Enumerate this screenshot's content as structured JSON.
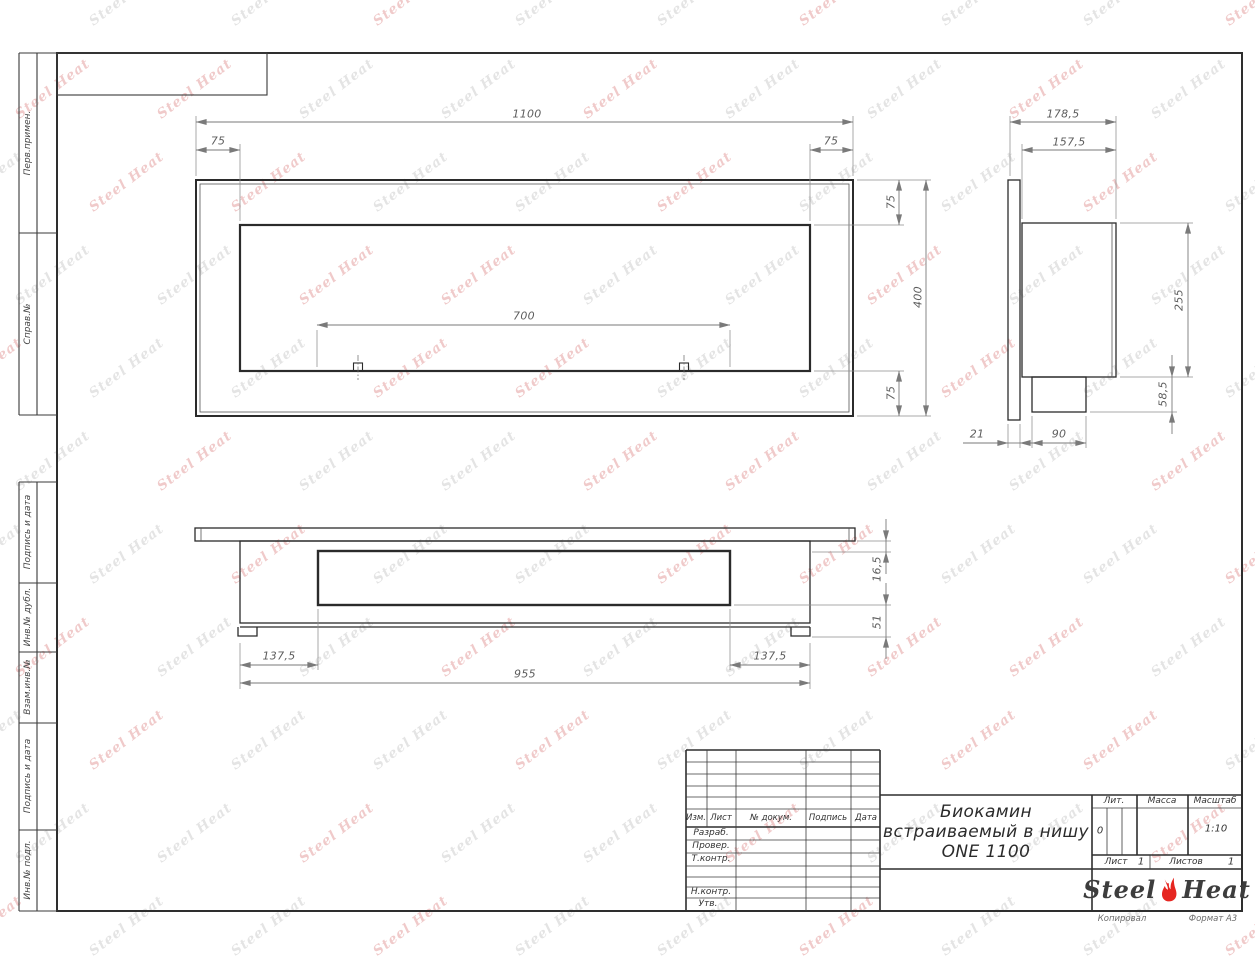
{
  "watermark": {
    "text": "Steel Heat"
  },
  "margin_labels": {
    "perv_primen": "Перв.примен.",
    "sprav_no": "Справ.№",
    "podpis_data_1": "Подпись и дата",
    "inv_dubl": "Инв.№ дубл.",
    "vzam_inv": "Взам.инв.№",
    "podpis_data_2": "Подпись и дата",
    "inv_podl": "Инв.№ подл."
  },
  "dims": {
    "front_width": "1100",
    "front_left_offset": "75",
    "front_right_offset": "75",
    "front_burner_length": "700",
    "front_top_offset": "75",
    "front_height": "400",
    "front_bottom_offset": "75",
    "side_depth_total": "178,5",
    "side_depth_body": "157,5",
    "side_body_height": "255",
    "side_box_height": "58,5",
    "side_flange_thickness": "21",
    "side_box_width": "90",
    "bottom_recess": "16,5",
    "bottom_drop": "51",
    "bottom_inset_left": "137,5",
    "bottom_body_length": "955",
    "bottom_inset_right": "137,5"
  },
  "title_block": {
    "headers": {
      "izm": "Изм.",
      "list": "Лист",
      "doc_no": "№ докум.",
      "podpis": "Подпись",
      "data": "Дата"
    },
    "rows": {
      "razrab": "Разраб.",
      "prover": "Провер.",
      "tkontr": "Т.контр.",
      "nkontr": "Н.контр.",
      "utv": "Утв."
    },
    "title_line1": "Биокамин",
    "title_line2": "встраиваемый в нишу",
    "title_line3": "ONE 1100",
    "lit_label": "Лит.",
    "lit_value": "0",
    "massa_label": "Масса",
    "masshtab_label": "Масштаб",
    "masshtab_value": "1:10",
    "list_label": "Лист",
    "list_value": "1",
    "listov_label": "Листов",
    "listov_value": "1",
    "logo_steel": "Steel",
    "logo_heat": "Heat"
  },
  "footer": {
    "copied": "Копировал",
    "format": "Формат А3"
  }
}
